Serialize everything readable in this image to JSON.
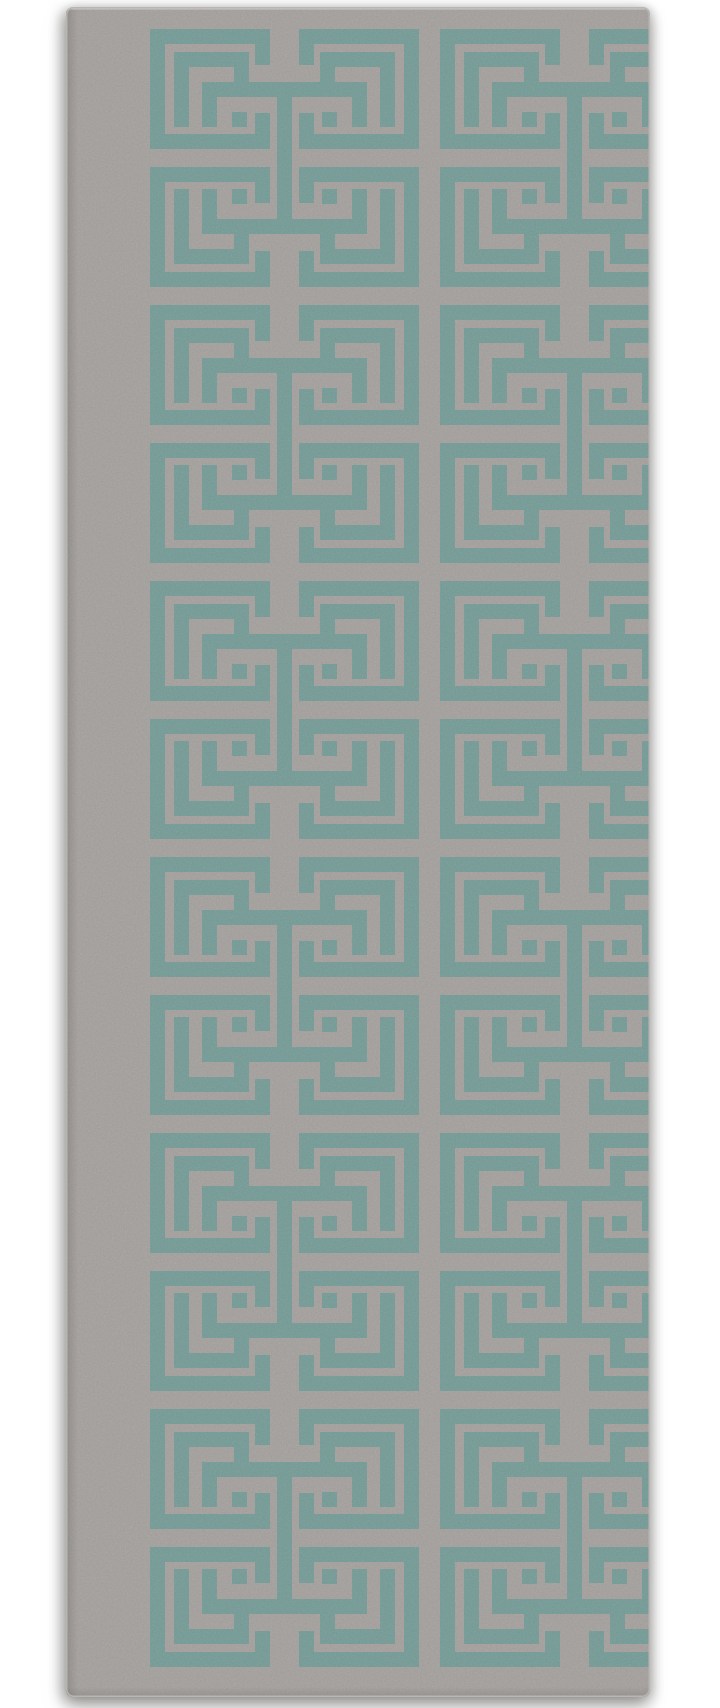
{
  "meta": {
    "description": "Product photo of a grey runner rug with an interlocking teal Greek-key fret lattice pattern, photographed on a plain white background"
  },
  "canvas": {
    "width": 720,
    "height": 1708,
    "background": "#ffffff"
  },
  "rug": {
    "x": 66,
    "y": 7,
    "width": 584,
    "height": 1690,
    "corner_radius": 7,
    "field_color": "#a7a3a1",
    "pattern_color": "#769e99",
    "edge_stroke": "#b9b5b3",
    "top_highlight": "#d3cfcc",
    "inner_shade": "#4a4846",
    "grain_dark_opacity": 0.4,
    "grain_light_opacity": 0.3
  },
  "pattern": {
    "columns_x": [
      84,
      374
    ],
    "first_row_y": 22,
    "row_pitch": 138,
    "row_count": 12,
    "first_row_flipped": true,
    "motif": {
      "width": 269,
      "height": 120,
      "stroke": 15,
      "rects": [
        {
          "name": "outer-top-bar-left",
          "x": 0,
          "y": 0,
          "w": 120,
          "h": 15
        },
        {
          "name": "outer-top-bar-right",
          "x": 149,
          "y": 0,
          "w": 120,
          "h": 15
        },
        {
          "name": "outer-left-vertical",
          "x": 0,
          "y": 0,
          "w": 15,
          "h": 120
        },
        {
          "name": "outer-right-vertical",
          "x": 254,
          "y": 0,
          "w": 15,
          "h": 120
        },
        {
          "name": "outer-bottom-bar-left",
          "x": 0,
          "y": 105,
          "w": 120,
          "h": 15
        },
        {
          "name": "outer-bottom-bar-right",
          "x": 149,
          "y": 105,
          "w": 120,
          "h": 15
        },
        {
          "name": "top-stub-left",
          "x": 105,
          "y": 15,
          "w": 15,
          "h": 21
        },
        {
          "name": "top-stub-right",
          "x": 149,
          "y": 15,
          "w": 15,
          "h": 21
        },
        {
          "name": "bottom-stub-left",
          "x": 105,
          "y": 84,
          "w": 15,
          "h": 21
        },
        {
          "name": "bottom-stub-right",
          "x": 149,
          "y": 84,
          "w": 15,
          "h": 21
        },
        {
          "name": "eye-square-left",
          "x": 82,
          "y": 22,
          "w": 15,
          "h": 15
        },
        {
          "name": "eye-square-right",
          "x": 172,
          "y": 22,
          "w": 15,
          "h": 15
        },
        {
          "name": "bridge-bar",
          "x": 52,
          "y": 52,
          "w": 165,
          "h": 15
        },
        {
          "name": "bridge-stub-left",
          "x": 52,
          "y": 22,
          "w": 15,
          "h": 30
        },
        {
          "name": "bridge-stub-right",
          "x": 202,
          "y": 22,
          "w": 15,
          "h": 30
        },
        {
          "name": "hook-left-vertical",
          "x": 24,
          "y": 22,
          "w": 15,
          "h": 75
        },
        {
          "name": "hook-left-bottom",
          "x": 24,
          "y": 82,
          "w": 75,
          "h": 15
        },
        {
          "name": "hook-left-upturn",
          "x": 84,
          "y": 67,
          "w": 15,
          "h": 15
        },
        {
          "name": "hook-right-vertical",
          "x": 230,
          "y": 22,
          "w": 15,
          "h": 75
        },
        {
          "name": "hook-right-bottom",
          "x": 170,
          "y": 82,
          "w": 75,
          "h": 15
        },
        {
          "name": "hook-right-upturn",
          "x": 170,
          "y": 67,
          "w": 15,
          "h": 15
        },
        {
          "name": "chain-vertical",
          "x": 127,
          "y": -18,
          "w": 15,
          "h": 85
        }
      ]
    }
  }
}
